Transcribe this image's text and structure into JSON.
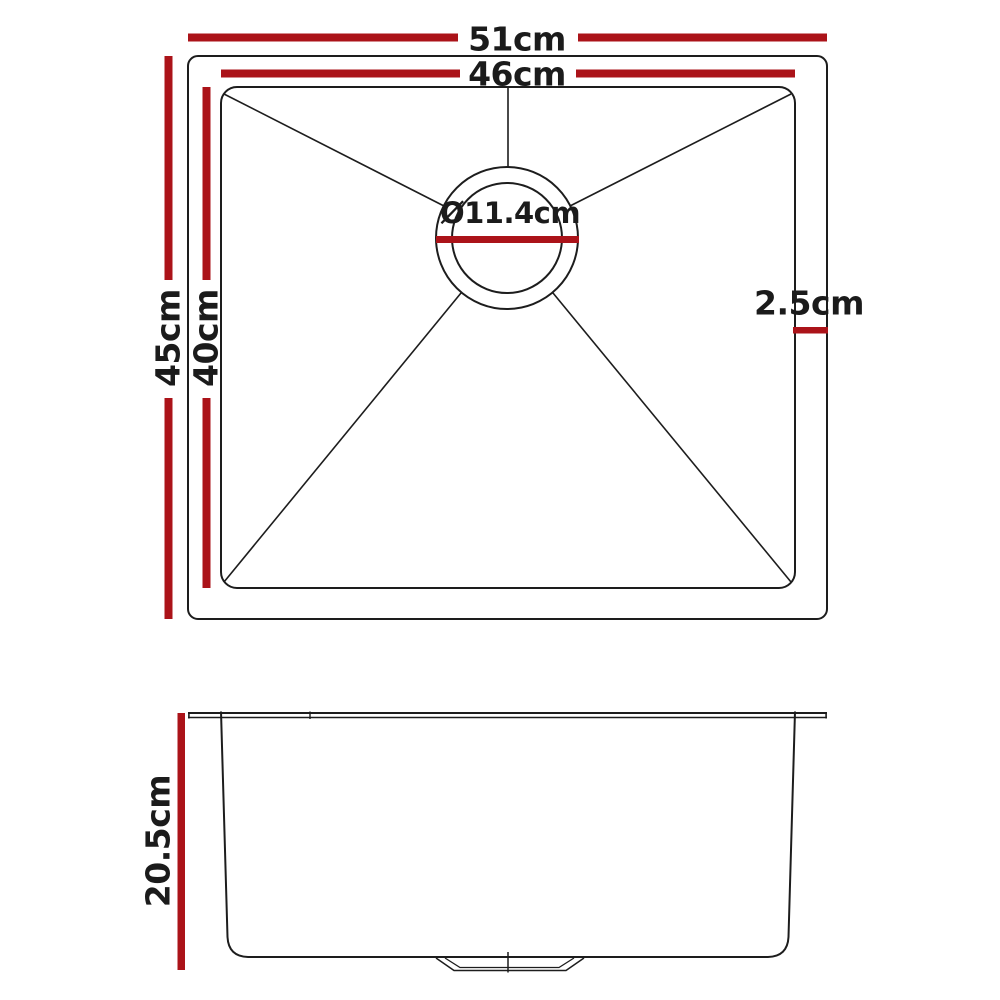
{
  "diagram": {
    "colors": {
      "dimension": "#ab1319",
      "outline": "#1d1d1d"
    },
    "views": {
      "top_view": {
        "overall_width": {
          "label": "51cm",
          "value_cm": 51
        },
        "bowl_width": {
          "label": "46cm",
          "value_cm": 46
        },
        "overall_depth": {
          "label": "45cm",
          "value_cm": 45
        },
        "bowl_depth": {
          "label": "40cm",
          "value_cm": 40
        },
        "drain_diameter": {
          "label": "Ø11.4cm",
          "value_cm": 11.4
        },
        "rim_width": {
          "label": "2.5cm",
          "value_cm": 2.5
        }
      },
      "side_view": {
        "bowl_height": {
          "label": "20.5cm",
          "value_cm": 20.5
        }
      }
    }
  }
}
